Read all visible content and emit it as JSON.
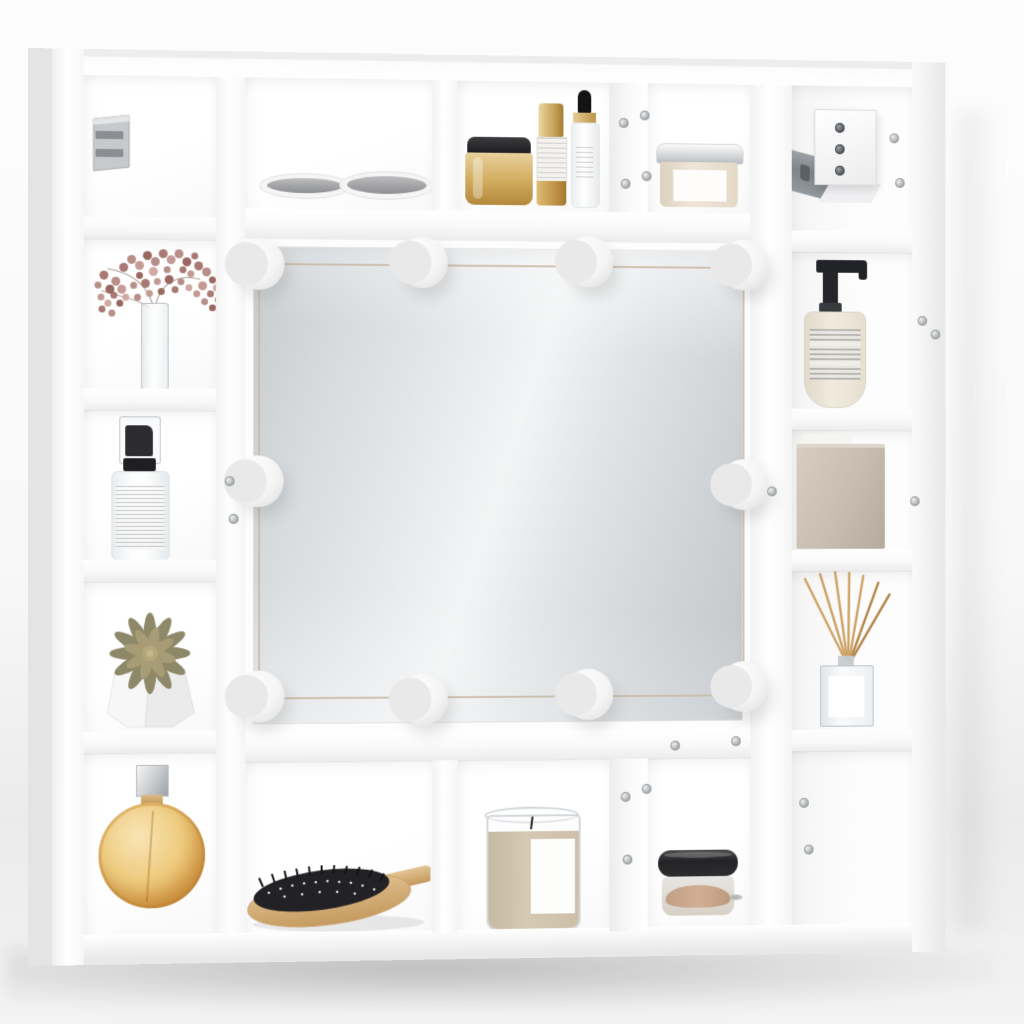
{
  "scene": {
    "type": "product-photo",
    "title": "White high-gloss LED mirror cabinet with cube shelves",
    "description": "Wall-mounted white shelving unit framing a central rectangular mirror fitted with ten round hollywood-style LED bulbs (4 top, 4 bottom, 1 each side). The surrounding cubbies are styled with cosmetics and decor; metal wall-mount brackets are visible in the two top corner cubbies and silver screws dot the panels.",
    "colors": {
      "unit_white": "#ffffff",
      "mirror_base": "#d8dcdf",
      "bulb_white": "#f4f4f4",
      "wire_tan": "#c8b9a4",
      "mauve_flowers": "#b78e88",
      "olive_succulent": "#8d8867",
      "amber_perfume": "#e0a750",
      "gold": "#d1ab5e",
      "soap_cream": "#f1ebdf",
      "taupe": "#c6bdb0",
      "wax": "#d6c9b4",
      "wood": "#d7b88b",
      "bristle_black": "#222226",
      "metal_gray": "#9aa0a4"
    },
    "mirror": {
      "bulb_count": 10,
      "bulb_layout": {
        "top": 4,
        "bottom": 4,
        "left": 1,
        "right": 1
      },
      "state": "off"
    },
    "objects": [
      {
        "id": "wall-bracket-left",
        "label": "metal wall-mount cleat",
        "cell": "top-left corner cubby"
      },
      {
        "id": "makeup-palettes",
        "label": "two round makeup compacts lying flat",
        "cell": "top row, first cubby"
      },
      {
        "id": "gold-jar",
        "label": "gold cream jar with black lid",
        "cell": "top row, second cubby"
      },
      {
        "id": "gold-pump-bottle",
        "label": "gold-capped cosmetic pump bottle",
        "cell": "top row, second cubby"
      },
      {
        "id": "dropper-bottle",
        "label": "white serum bottle with black dropper",
        "cell": "top row, second cubby"
      },
      {
        "id": "cream-jar",
        "label": "beige cream jar with silver lid",
        "cell": "top row, third cubby"
      },
      {
        "id": "wall-bracket-right",
        "label": "white hanging bracket with gray metal rail",
        "cell": "top-right corner cubby"
      },
      {
        "id": "dried-flowers",
        "label": "dried mauve flowers in tall glass vase",
        "cell": "left column, second cubby"
      },
      {
        "id": "spray-bottle",
        "label": "clear spray bottle with black nozzle and text label",
        "cell": "left column, third cubby"
      },
      {
        "id": "succulent",
        "label": "olive succulent in white faceted pot",
        "cell": "left column, fourth cubby"
      },
      {
        "id": "perfume-bottle",
        "label": "round amber perfume bottle with square silver cap",
        "cell": "left column, bottom cubby"
      },
      {
        "id": "soap-dispenser",
        "label": "cream soap dispenser with black pump",
        "cell": "right column, second cubby"
      },
      {
        "id": "storage-box",
        "label": "taupe storage box",
        "cell": "right column, third cubby"
      },
      {
        "id": "reed-diffuser",
        "label": "square glass reed diffuser with wooden sticks",
        "cell": "right column, fourth cubby"
      },
      {
        "id": "empty-cubby",
        "label": "empty cubby with visible screws",
        "cell": "right column, bottom cubby"
      },
      {
        "id": "hairbrush",
        "label": "wooden paddle hairbrush with black bristles",
        "cell": "bottom row, first cubby"
      },
      {
        "id": "candle",
        "label": "beige candle in clear glass tumbler",
        "cell": "bottom row, second cubby"
      },
      {
        "id": "powder-jar",
        "label": "loose-powder jar with black lid",
        "cell": "bottom row, third cubby"
      }
    ]
  }
}
